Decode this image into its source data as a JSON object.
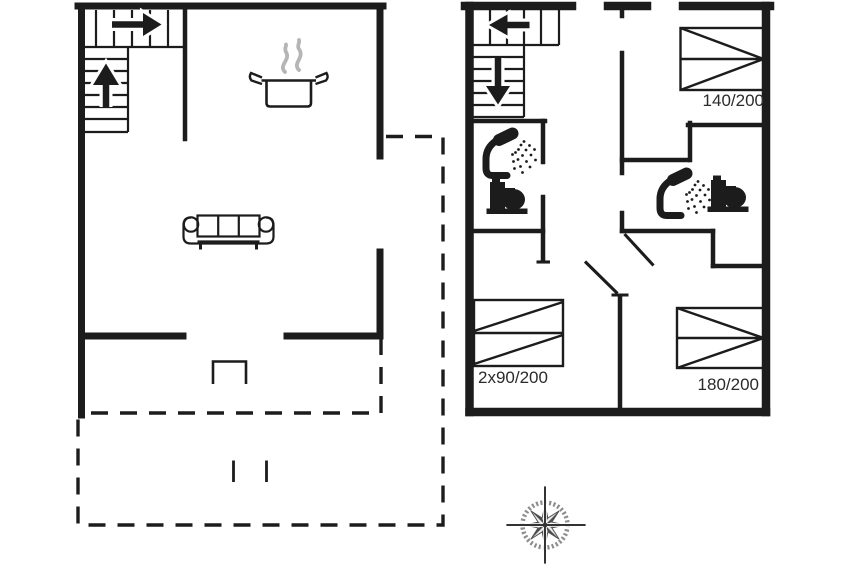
{
  "document": {
    "type": "floor-plan",
    "floors": 2
  },
  "ground_floor": {
    "features": [
      "staircase-icon",
      "stove-icon",
      "sofa-icon",
      "terrace-dashed-outline",
      "door-threshold",
      "terrace-step-marks"
    ]
  },
  "upper_floor": {
    "features": [
      "staircase-icon",
      "shower-icon",
      "toilet-icon",
      "shower-icon",
      "toilet-icon",
      "door-swing",
      "door-swing"
    ],
    "beds": [
      {
        "label": "140/200"
      },
      {
        "label": "2x90/200"
      },
      {
        "label": "180/200"
      }
    ]
  },
  "compass": {
    "type": "compass-rose",
    "long_points": "N-E-S-W"
  },
  "colors": {
    "line": "#1c1c1c",
    "steam": "#b5b5b5",
    "compass_gray": "#8d8d8d",
    "background": "#ffffff",
    "label_text": "#2b2b2b"
  }
}
